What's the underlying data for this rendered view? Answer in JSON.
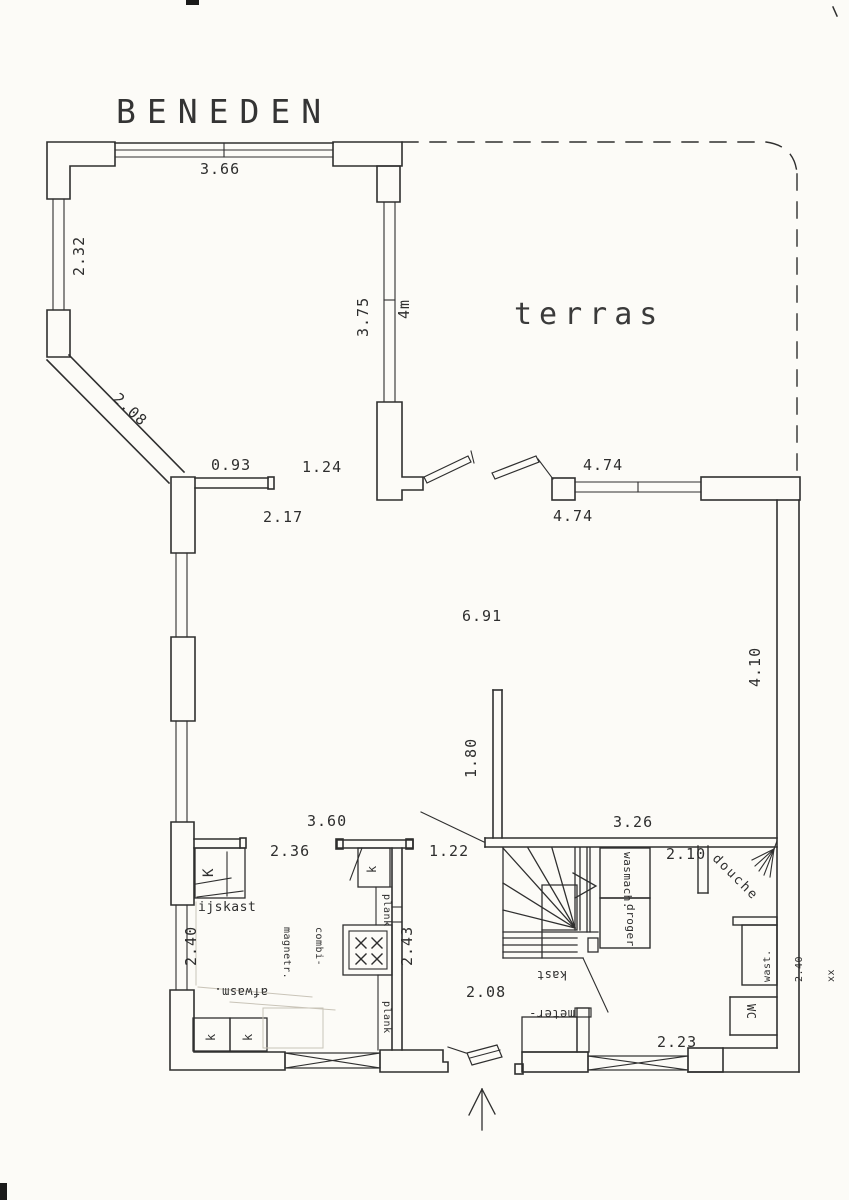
{
  "document": {
    "floor_title": "BENEDEN"
  },
  "colors": {
    "ink": "#2f2f2f",
    "paper": "#fcfbf7",
    "pencil": "#c9c4b8"
  },
  "labels": {
    "title": "BENEDEN",
    "terrace": "terras",
    "dim_366": "3.66",
    "dim_232": "2.32",
    "dim_208_diag": "2.08",
    "dim_375": "3.75",
    "dim_4m": "4m",
    "dim_093": "0.93",
    "dim_124": "1.24",
    "dim_217": "2.17",
    "dim_474_top": "4.74",
    "dim_474_bot": "4.74",
    "dim_691": "6.91",
    "dim_180": "1.80",
    "dim_410": "4.10",
    "dim_360": "3.60",
    "dim_236": "2.36",
    "dim_122": "1.22",
    "dim_326": "3.26",
    "dim_210": "2.10",
    "dim_240_kitchen": "2.40",
    "dim_243": "2.43",
    "dim_208_hall": "2.08",
    "dim_223": "2.23",
    "fridge": "ijskast",
    "fridge_k": "K",
    "dishwasher": "afwasm.",
    "microwave_1": "combi-",
    "microwave_2": "magnetr.",
    "shelf_upper": "plank",
    "shelf_lower": "plank",
    "cab_k_top": "k",
    "cab_k_left": "k",
    "cab_k_right": "k",
    "washer": "wasmach.",
    "dryer": "droger",
    "meter_1": "meter-",
    "meter_2": "kast",
    "shower": "douche",
    "basin_1": "wast.",
    "basin_2": "2.40",
    "basin_3": "xx",
    "wc": "WC"
  }
}
